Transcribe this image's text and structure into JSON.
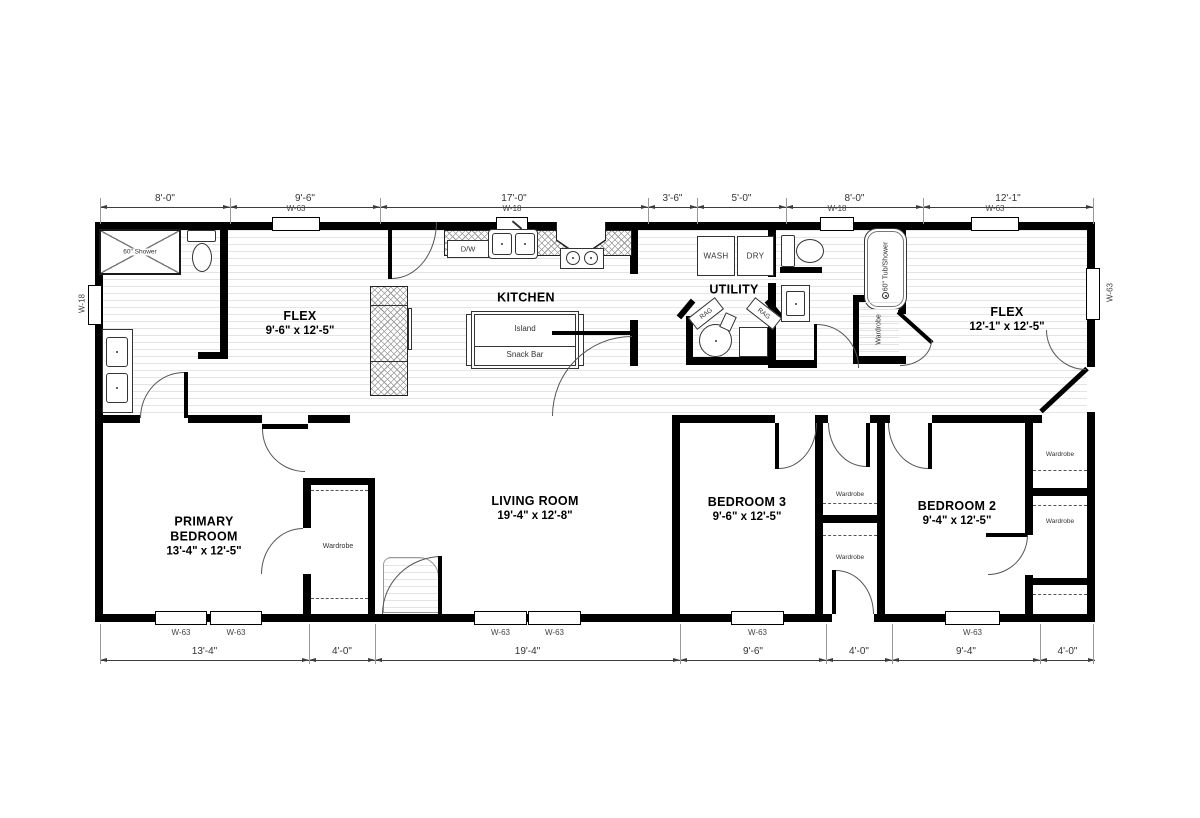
{
  "rooms": [
    {
      "name": "FLEX",
      "dims": "9'-6\" x  12'-5\""
    },
    {
      "name": "KITCHEN",
      "dims": ""
    },
    {
      "name": "UTILITY",
      "dims": ""
    },
    {
      "name": "FLEX",
      "dims": "12'-1\" x  12'-5\""
    },
    {
      "name": "PRIMARY",
      "name2": "BEDROOM",
      "dims": "13'-4\" x  12'-5\""
    },
    {
      "name": "LIVING ROOM",
      "dims": "19'-4\" x  12'-8\""
    },
    {
      "name": "BEDROOM 3",
      "dims": "9'-6\" x  12'-5\""
    },
    {
      "name": "BEDROOM 2",
      "dims": "9'-4\" x  12'-5\""
    }
  ],
  "fixtures": {
    "shower": "60\" Shower",
    "tub": "60\" Tub/Shower",
    "dw": "D/W",
    "island": "Island",
    "snack_bar": "Snack Bar",
    "wash": "WASH",
    "dry": "DRY",
    "rag": "RAG",
    "wardrobe": "Wardrobe"
  },
  "windows": {
    "w63": "W-63",
    "w18": "W-18"
  },
  "dimensions": {
    "top": [
      "8'-0\"",
      "9'-6\"",
      "17'-0\"",
      "3'-6\"",
      "5'-0\"",
      "8'-0\"",
      "12'-1\""
    ],
    "bottom": [
      "13'-4\"",
      "4'-0\"",
      "19'-4\"",
      "9'-6\"",
      "4'-0\"",
      "9'-4\"",
      "4'-0\""
    ]
  }
}
